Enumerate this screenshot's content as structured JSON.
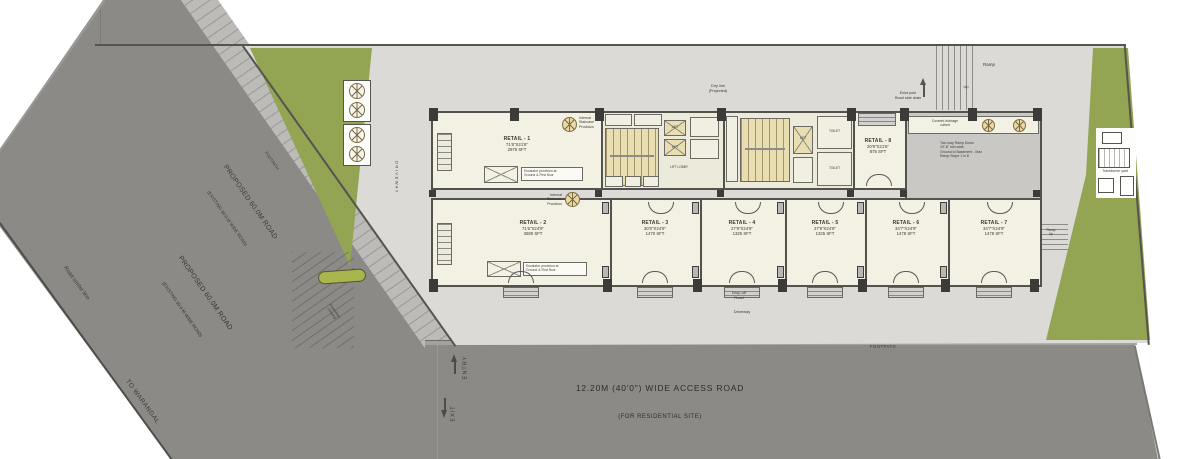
{
  "roads": {
    "proposed_line1": "PROPOSED 60.0M ROAD",
    "proposed_line2": "(EXISTING 30.0 M WIDE ROAD)",
    "center_line": "Road center line",
    "to_warangal": "TO WARANGAL",
    "footpath": "FOOTPATH",
    "access_road": "12.20M (40'0\") WIDE ACCESS ROAD",
    "access_road_sub": "(FOR RESIDENTIAL SITE)",
    "entry": "ENTRY",
    "exit": "EXIT"
  },
  "site_labels": {
    "ramp": "Ramp",
    "up": "Up",
    "drip": "Drip line\n(Projected)",
    "pole": "Exist pole\nRoad side drain",
    "driveway": "DRIVEWAY",
    "dropoff": "Drop-off\nRoad",
    "driveway2": "Driveway",
    "crossing": "Pedestrian\ncrossing",
    "transformer": "Transformer yard",
    "ramp_side": "Ramp\nUp"
  },
  "units": [
    {
      "name": "RETAIL - 1",
      "dims": "71'6\"X21'6\"",
      "area": "2975 SFT"
    },
    {
      "name": "RETAIL - 2",
      "dims": "71'6\"X24'9\"",
      "area": "3580 SFT"
    },
    {
      "name": "RETAIL - 3",
      "dims": "30'0\"X24'9\"",
      "area": "1470 SFT"
    },
    {
      "name": "RETAIL - 4",
      "dims": "27'9\"X24'9\"",
      "area": "1325 SFT"
    },
    {
      "name": "RETAIL - 5",
      "dims": "27'9\"X24'9\"",
      "area": "1325 SFT"
    },
    {
      "name": "RETAIL - 6",
      "dims": "34'7\"X24'9\"",
      "area": "1478 SFT"
    },
    {
      "name": "RETAIL - 7",
      "dims": "34'7\"X24'9\"",
      "area": "1478 SFT"
    },
    {
      "name": "RETAIL - 8",
      "dims": "20'9\"X21'6\"",
      "area": "875 SFT"
    }
  ],
  "core": {
    "lift": "LIFT",
    "lift_lobby": "LIFT LOBBY",
    "toilet": "TOILET"
  },
  "notes": {
    "internal_stair": "Internal\nStaircase\nProvision",
    "escalator": "Escalator provision at\nGround & First floor",
    "ramp_note": "Two way Ramp Down\n10'-8\" min wide\nGround to Basement - Max\nRamp Slope 1 in 8",
    "culvert": "Covered drainage\nculvert"
  },
  "colors": {
    "road": "#8b8a87",
    "footpath_band": "#bcbbb8",
    "site": "#dbdad6",
    "green": "#93a452",
    "median_green": "#a9b54d",
    "room_fill": "#f3f1e4",
    "stair_tan": "#e9ddb2",
    "wall": "#53524d",
    "ramp_area": "#c9c8c4"
  }
}
